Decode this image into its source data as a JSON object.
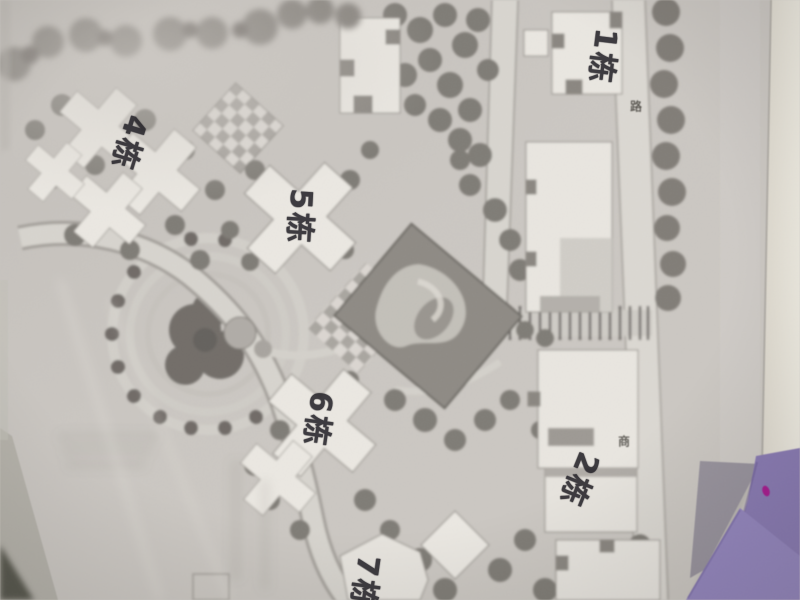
{
  "plan": {
    "building_labels": [
      {
        "id": "building-1",
        "text": "1栋"
      },
      {
        "id": "building-2",
        "text": "2栋"
      },
      {
        "id": "building-4",
        "text": "4栋"
      },
      {
        "id": "building-5",
        "text": "5栋"
      },
      {
        "id": "building-6",
        "text": "6栋"
      },
      {
        "id": "building-7",
        "text": "7栋"
      }
    ],
    "printed_markers": [
      {
        "text": "路"
      },
      {
        "text": "商"
      }
    ]
  },
  "colors": {
    "paper": "#c9c5c0",
    "handwriting_ink": "#26242a",
    "sticky_note_purple": "#8a79b7",
    "sticky_note_purple_light": "#9585c3",
    "sticky_note_grey": "#98939e",
    "margin_cream": "#eae7db",
    "table_corner_dark": "#57564c",
    "pond_dark": "#8e8a83",
    "accent_dot_magenta": "#b01895"
  }
}
